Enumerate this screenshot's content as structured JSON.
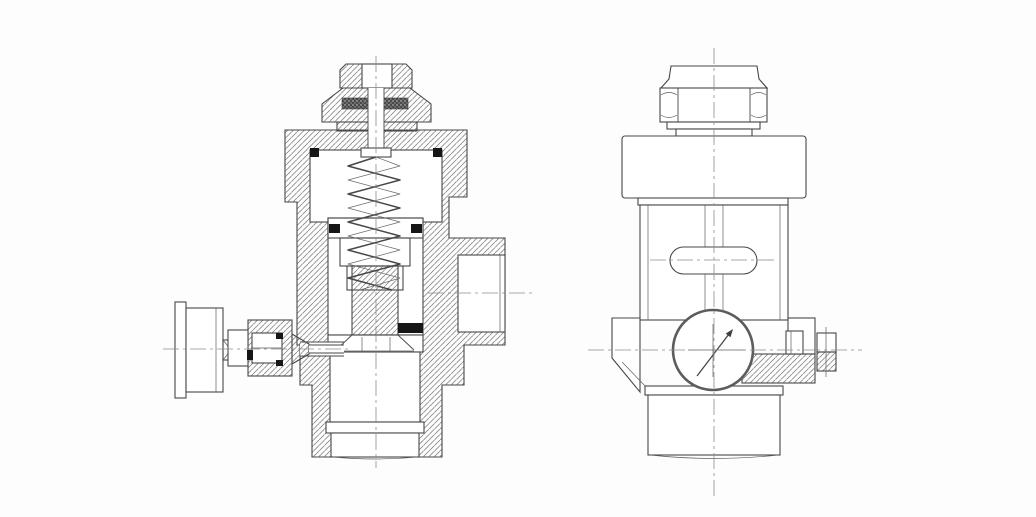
{
  "canvas": {
    "width": 1036,
    "height": 517,
    "background": "#fdfdfd"
  },
  "drawing": {
    "style": "cad-technical-2d-drawing",
    "subject": "pressure-regulator-valve",
    "colors": {
      "outline": "#474747",
      "hatch_line": "#757575",
      "o_ring_seal": "#161616",
      "stipple_seal": "#3a3a3a",
      "centerline": "#8c8c8c",
      "gauge_rim": "#5c5c5c",
      "fill_white": "#ffffff",
      "background": "#fdfdfd"
    },
    "views": {
      "left": {
        "id": "sectional-view",
        "components": [
          "adjusting-bolt",
          "gland-nut",
          "stipple-seal",
          "adjusting-stem",
          "coil-spring",
          "spring-chamber",
          "o-ring-seals",
          "piston",
          "valve-seat",
          "valve-body",
          "side-outlet-port",
          "bottom-port-plug",
          "gauge-knob",
          "gauge-gland-fitting"
        ]
      },
      "right": {
        "id": "side-elevation-view",
        "components": [
          "top-cap",
          "hex-nut",
          "bonnet-band",
          "body-column",
          "slot-window",
          "dial-gauge",
          "gauge-needle",
          "breakout-hatch-section",
          "side-fitting",
          "bottom-outlet-cylinder"
        ]
      }
    }
  }
}
